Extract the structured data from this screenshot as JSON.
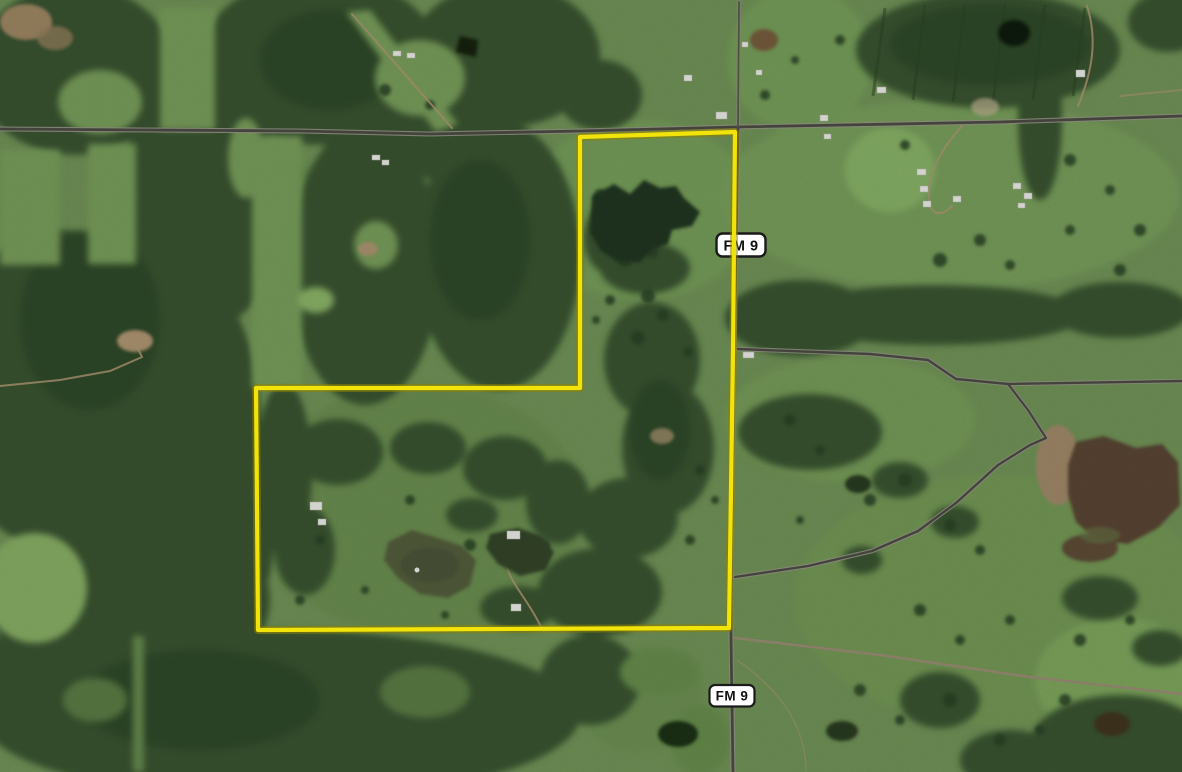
{
  "map": {
    "view_type": "satellite-aerial",
    "shields": [
      {
        "text": "FM 9"
      },
      {
        "text": "FM 9"
      }
    ],
    "boundary": {
      "points": "580,137 735,132 733,352 729,628 258,630 256,388 580,388",
      "stroke_width": 4.2
    },
    "palette": {
      "pasture": "#74975a",
      "pasture_bright": "#8cb468",
      "forest": "#3b5733",
      "forest_dark": "#2c4527",
      "road_core": "#4e4e46",
      "road_casing": "#9a9a8c",
      "dirt_trail": "#b39c77",
      "pond_dark": "#223720",
      "pond_murky": "#56613e",
      "pond_brown": "#5c4734",
      "building": "#f2f2ee",
      "boundary": "#f2e40a",
      "boundary_glow": "#8a7f00",
      "shield_bg": "#ffffff",
      "shield_border": "#1a1a1a",
      "shield_text": "#111111"
    }
  }
}
